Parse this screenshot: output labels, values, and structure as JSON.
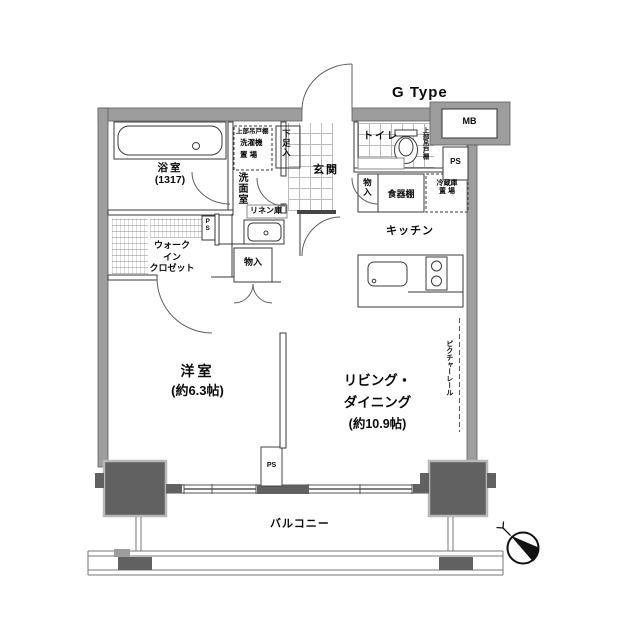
{
  "plan": {
    "type_label": "G Type",
    "rooms": {
      "bathroom": {
        "name": "浴室",
        "size": "(1317)"
      },
      "walk_in_closet": {
        "line1": "ウォーク",
        "line2": "イン",
        "line3": "クロゼット"
      },
      "washroom": {
        "name": "洗面室"
      },
      "entrance": {
        "name": "玄関"
      },
      "toilet": {
        "name": "トイレ"
      },
      "kitchen": {
        "name": "キッチン"
      },
      "western_room": {
        "name": "洋室",
        "size": "(約6.3帖)"
      },
      "living_dining": {
        "line1": "リビング・",
        "line2": "ダイニング",
        "size": "(約10.9帖)"
      },
      "balcony": {
        "name": "バルコニー"
      }
    },
    "fixtures": {
      "shoe_cabinet": "下足入",
      "washer_upper_shelf": "上部吊戸棚",
      "washer": "洗濯機",
      "washer_place": "置 場",
      "linen_storage": "リネン庫",
      "hall_closet": "物入",
      "dish_shelf": "食器棚",
      "fridge_line1": "冷蔵庫",
      "fridge_line2": "置 場",
      "toilet_upper_shelf": "上部吊戸棚",
      "bedroom_closet": "物入",
      "picture_rail": "ピクチャーレール",
      "meter_box": "MB",
      "ps_top": "PS",
      "ps_closet": "PS",
      "ps_bottom": "PS"
    },
    "colors": {
      "wall_gray": "#9d9d9d",
      "pillar_dark": "#616161",
      "line_dark": "#3a3a3a"
    }
  }
}
